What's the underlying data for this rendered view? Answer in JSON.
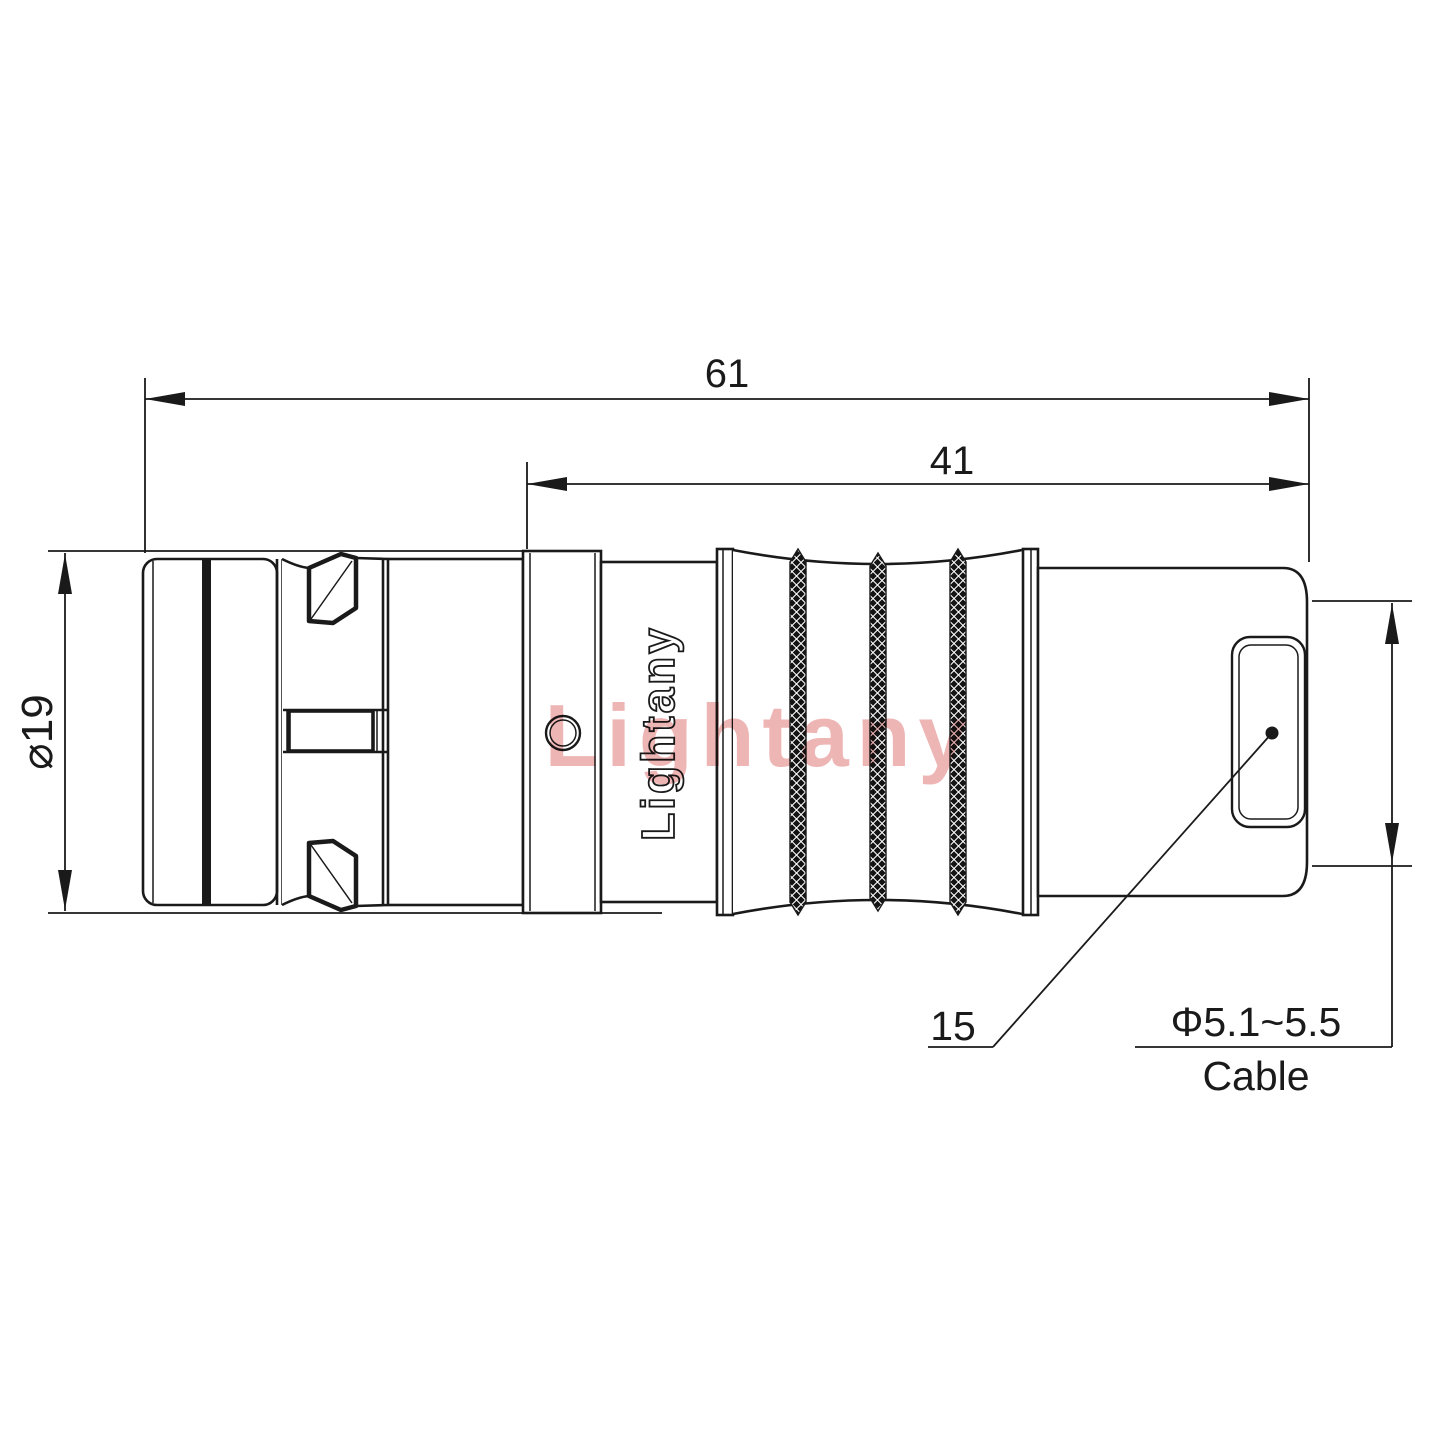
{
  "drawing_labels": {
    "dim_overall_length": "61",
    "dim_front_length": "41",
    "dim_outer_diameter": "⌀19",
    "dim_boot_length": "15",
    "dim_cable_range": "Φ5.1~5.5",
    "dim_cable_caption": "Cable",
    "brand_logo": "Lightany",
    "watermark": "Lightany"
  },
  "colors": {
    "line": "#1a1a1a",
    "background": "#ffffff",
    "watermark_red": "#eba8a8"
  }
}
